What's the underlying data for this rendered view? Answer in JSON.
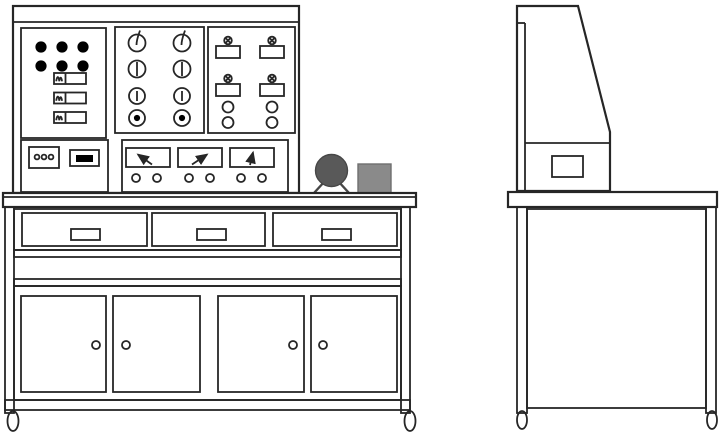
{
  "colors": {
    "background": "#ffffff",
    "line": "#262626",
    "indicator_dot": "#000000",
    "switch_bar": "#000000",
    "motor_body": "#595959",
    "motor_outline": "#474747",
    "accessory_box": "#8a8a8a",
    "accessory_box_outline": "#6f6f6f"
  },
  "front_view": {
    "control_panel": {
      "indicator_lights": 6,
      "rocker_switches": 3,
      "knob_rows": 4,
      "knob_columns": 2,
      "terminal_blocks": 4,
      "banana_sockets": 4,
      "power_socket_pins": 3,
      "panel_switch_count": 1,
      "analog_meters": 3,
      "meter_terminals": 6
    },
    "bench": {
      "drawers": 3,
      "drawer_handles": 3,
      "cabinet_doors": 4,
      "door_knobs": 4,
      "casters": 2
    },
    "tabletop_items": {
      "motor_count": 1,
      "box_count": 1
    }
  },
  "side_view": {
    "console_drawer_count": 1,
    "legs": 2,
    "casters": 2
  }
}
